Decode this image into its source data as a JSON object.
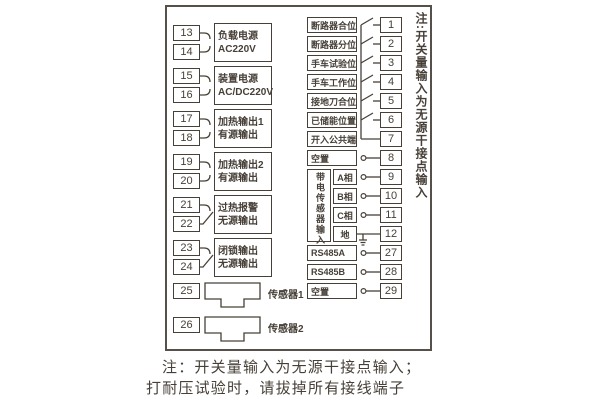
{
  "colors": {
    "ink": "#474038",
    "border": "#56504a",
    "background": "#ffffff"
  },
  "left_pairs": [
    {
      "terminals": [
        "13",
        "14"
      ],
      "label_lines": [
        "负载电源",
        "AC220V"
      ],
      "contact": "plug"
    },
    {
      "terminals": [
        "15",
        "16"
      ],
      "label_lines": [
        "装置电源",
        "AC/DC220V"
      ],
      "contact": "plug"
    },
    {
      "terminals": [
        "17",
        "18"
      ],
      "label_lines": [
        "加热输出1",
        "有源输出"
      ],
      "contact": "plug"
    },
    {
      "terminals": [
        "19",
        "20"
      ],
      "label_lines": [
        "加热输出2",
        "有源输出"
      ],
      "contact": "plug"
    },
    {
      "terminals": [
        "21",
        "22"
      ],
      "label_lines": [
        "过热报警",
        "无源输出"
      ],
      "contact": "switch"
    },
    {
      "terminals": [
        "23",
        "24"
      ],
      "label_lines": [
        "闭锁输出",
        "无源输出"
      ],
      "contact": "switch"
    }
  ],
  "sensors": [
    {
      "terminal": "25",
      "label": "传感器1"
    },
    {
      "terminal": "26",
      "label": "传感器2"
    }
  ],
  "right_rows": [
    {
      "terminal": "1",
      "label": "断路器合位",
      "symbol": "switch"
    },
    {
      "terminal": "2",
      "label": "断路器分位",
      "symbol": "switch"
    },
    {
      "terminal": "3",
      "label": "手车试验位",
      "symbol": "switch"
    },
    {
      "terminal": "4",
      "label": "手车工作位",
      "symbol": "switch"
    },
    {
      "terminal": "5",
      "label": "接地刀合位",
      "symbol": "switch"
    },
    {
      "terminal": "6",
      "label": "已储能位置",
      "symbol": "switch"
    },
    {
      "terminal": "7",
      "label": "开入公共端",
      "symbol": "line"
    },
    {
      "terminal": "8",
      "label": "空置",
      "symbol": "circle"
    },
    {
      "terminal": "9",
      "label": "A相",
      "symbol": "circle",
      "group": "sensor_input"
    },
    {
      "terminal": "10",
      "label": "B相",
      "symbol": "circle",
      "group": "sensor_input"
    },
    {
      "terminal": "11",
      "label": "C相",
      "symbol": "circle",
      "group": "sensor_input"
    },
    {
      "terminal": "12",
      "label": "地",
      "symbol": "ground",
      "group": "sensor_input"
    },
    {
      "terminal": "27",
      "label": "RS485A",
      "symbol": "circle"
    },
    {
      "terminal": "28",
      "label": "RS485B",
      "symbol": "circle"
    },
    {
      "terminal": "29",
      "label": "空置",
      "symbol": "circle"
    }
  ],
  "sensor_input_group_label": "带电传感器输入",
  "side_note": "注:开关量输入为无源干接点输入",
  "bottom_notes": [
    "注：开关量输入为无源干接点输入；",
    "打耐压试验时，请拔掉所有接线端子"
  ]
}
